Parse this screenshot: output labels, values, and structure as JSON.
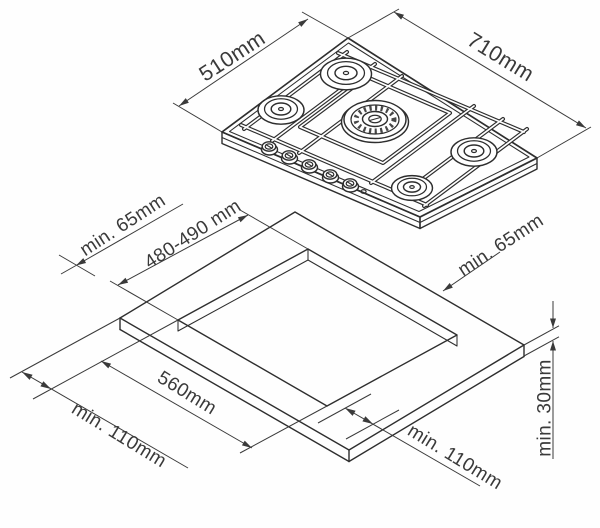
{
  "diagram": {
    "kind": "gas-hob-installation-drawing",
    "labels": {
      "hob_depth": "510mm",
      "hob_width": "710mm",
      "clearance_rear_left": "min. 65mm",
      "cutout_depth": "480-490 mm",
      "clearance_rear_right": "min. 65mm",
      "cutout_width": "560mm",
      "clearance_front_left": "min. 110mm",
      "clearance_front_right": "min. 110mm",
      "worktop_thickness": "min. 30mm"
    }
  },
  "colors": {
    "line": "#2e2e2e",
    "dimension": "#3a3a3a",
    "background": "#fefefe"
  }
}
